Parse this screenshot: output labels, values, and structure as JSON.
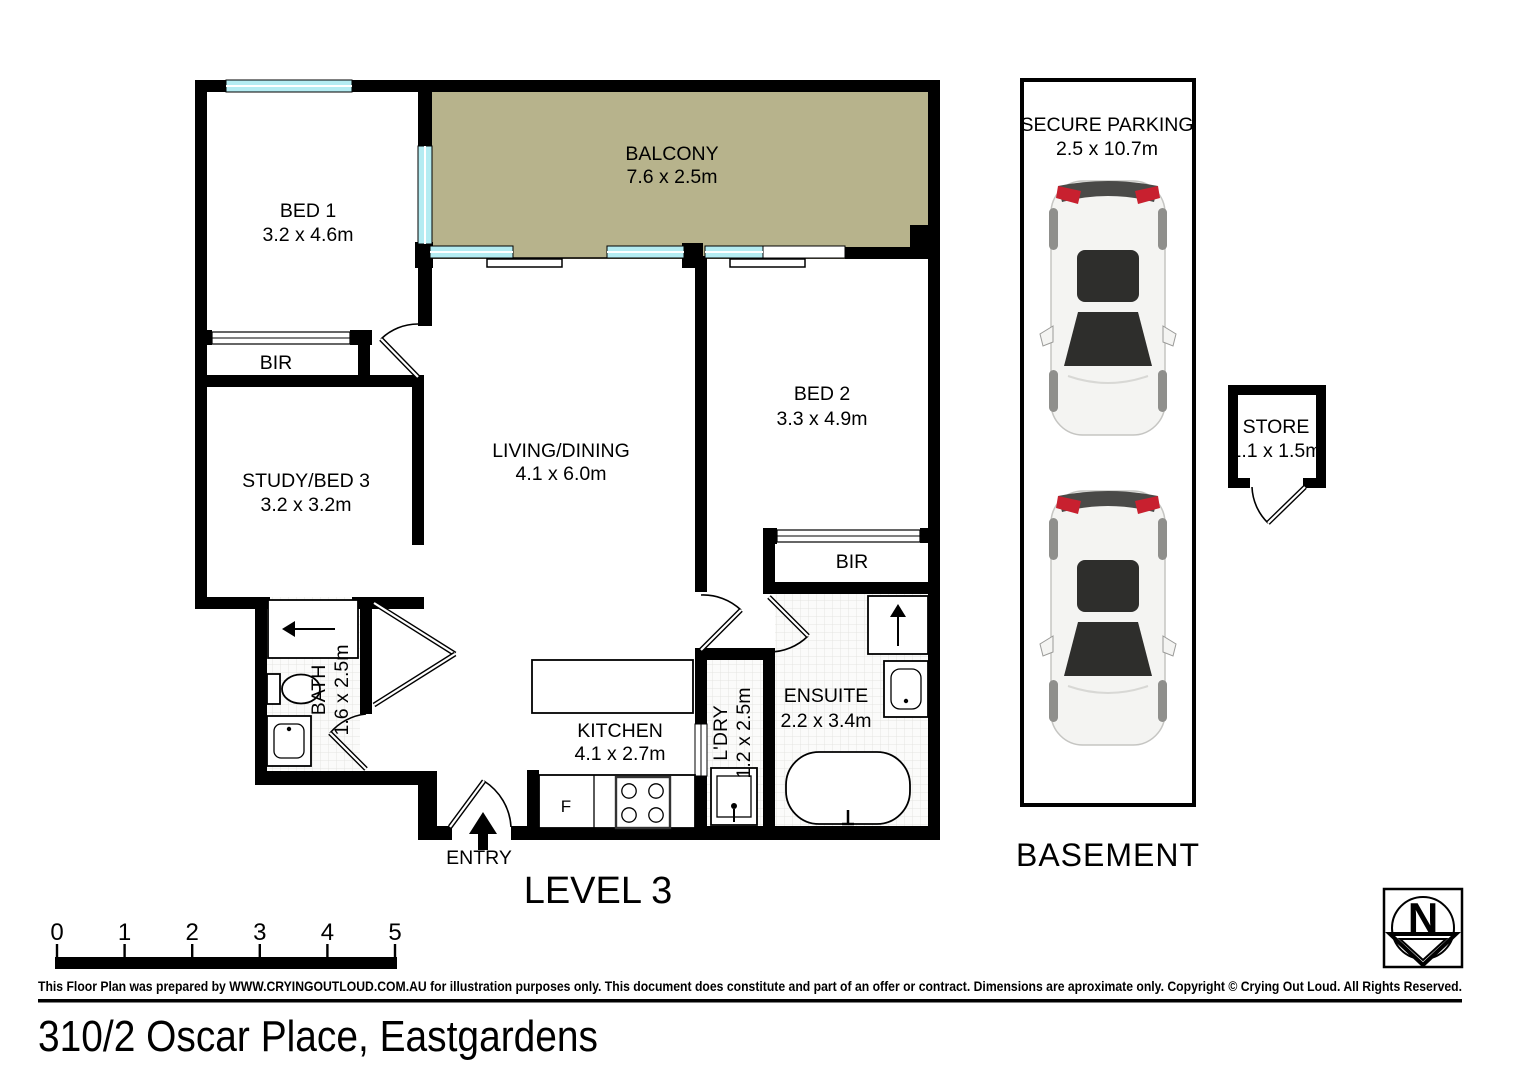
{
  "floorplan": {
    "level_label": "LEVEL 3",
    "entry_label": "ENTRY",
    "fridge_label": "F",
    "rooms": {
      "bed1": {
        "name": "BED 1",
        "dims": "3.2 x 4.6m"
      },
      "balcony": {
        "name": "BALCONY",
        "dims": "7.6 x 2.5m"
      },
      "bed2": {
        "name": "BED 2",
        "dims": "3.3 x 4.9m"
      },
      "bir1": {
        "name": "BIR"
      },
      "bir2": {
        "name": "BIR"
      },
      "study": {
        "name": "STUDY/BED 3",
        "dims": "3.2 x 3.2m"
      },
      "living": {
        "name": "LIVING/DINING",
        "dims": "4.1 x 6.0m"
      },
      "bath": {
        "name": "BATH",
        "dims": "1.6 x 2.5m"
      },
      "kitchen": {
        "name": "KITCHEN",
        "dims": "4.1 x 2.7m"
      },
      "ldry": {
        "name": "L'DRY",
        "dims": "1.2 x 2.5m"
      },
      "ensuite": {
        "name": "ENSUITE",
        "dims": "2.2 x 3.4m"
      }
    }
  },
  "basement": {
    "parking": {
      "name": "SECURE PARKING",
      "dims": "2.5 x 10.7m"
    },
    "label": "BASEMENT",
    "store": {
      "name": "STORE",
      "dims": "1.1 x 1.5m"
    }
  },
  "scale_bar": {
    "ticks": [
      "0",
      "1",
      "2",
      "3",
      "4",
      "5"
    ]
  },
  "north": {
    "label": "N"
  },
  "footer": {
    "disclaimer": "This Floor Plan was prepared by WWW.CRYINGOUTLOUD.COM.AU for illustration purposes only. This document does constitute and part of an offer or contract. Dimensions are aproximate only. Copyright © Crying Out Loud. All Rights Reserved.",
    "address": "310/2 Oscar Place, Eastgardens"
  },
  "colors": {
    "balcony": "#b7b38c",
    "window": "#b4ecf2",
    "car_red": "#c8202f"
  }
}
